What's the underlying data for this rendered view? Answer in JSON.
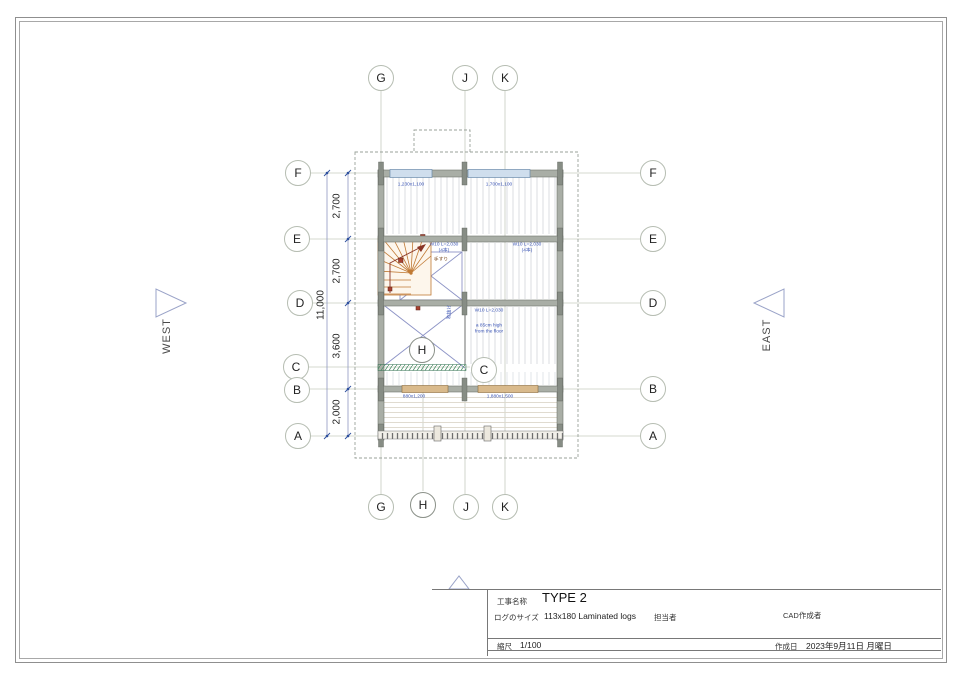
{
  "title_block": {
    "project_label": "工事名称",
    "project_value": "TYPE 2",
    "log_size_label": "ログのサイズ",
    "log_size_value": "113x180 Laminated logs",
    "staff_label": "担当者",
    "cad_label": "CAD作成者",
    "scale_label": "縮尺",
    "scale_value": "1/100",
    "date_label": "作成日",
    "date_value": "2023年9月11日 月曜日"
  },
  "compass": {
    "west": "WEST",
    "east": "EAST"
  },
  "grid": {
    "top": [
      "G",
      "J",
      "K"
    ],
    "bottom": [
      "G",
      "H",
      "J",
      "K"
    ],
    "left": [
      "F",
      "E",
      "D",
      "C",
      "B",
      "A"
    ],
    "right": [
      "F",
      "E",
      "D",
      "B",
      "A"
    ],
    "inner": [
      "H",
      "C"
    ]
  },
  "dimensions": {
    "segments": [
      "2,700",
      "2,700",
      "3,600",
      "2,000"
    ],
    "total": "11,000"
  },
  "plan_annotations": {
    "north_window_left": "1,230x1,100",
    "north_window_right": "1,700x1,100",
    "wall_e_left_l1": "W10 L=2,030",
    "wall_e_left_l2": "(4本)",
    "wall_e_right_l1": "W10 L=2,030",
    "wall_e_right_l2": "(4本)",
    "wall_d_label": "W10 L=2,030",
    "floor_note_l1": "a 85cm high",
    "floor_note_l2": "from the floor",
    "handrail_label": "手すり",
    "void_label": "吹抜け",
    "south_window_left": "880x1,200",
    "south_window_right": "1,880x1,500"
  }
}
